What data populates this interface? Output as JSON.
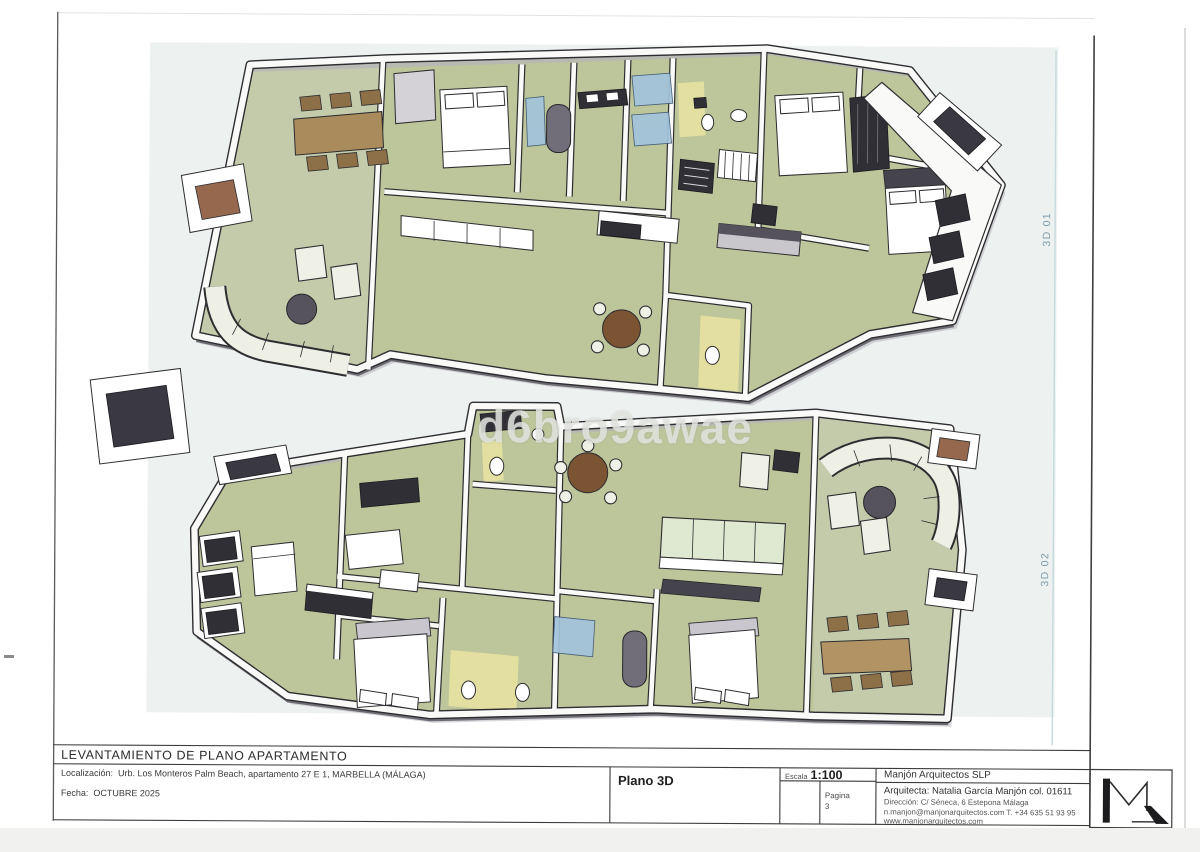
{
  "sheet": {
    "title_row": "LEVANTAMIENTO DE PLANO APARTAMENTO",
    "location": {
      "label": "Localización:",
      "value": "Urb. Los Monteros Palm Beach, apartamento 27 E 1, MARBELLA (MÁLAGA)"
    },
    "date": {
      "label": "Fecha:",
      "value": "OCTUBRE 2025"
    },
    "drawing_name": "Plano 3D",
    "scale": {
      "label": "Escala",
      "value": "1:100"
    },
    "page": {
      "label": "Pagina",
      "value": "3"
    },
    "firm": {
      "name": "Manjón Arquitectos SLP",
      "architect": "Arquitecta: Natalia García Manjón col. 01611",
      "address": "Dirección: C/ Séneca, 6 Estepona Málaga",
      "contact": "n.manjon@manjonarquitectos.com T. +34 635 51 93 95",
      "web": "www.manjonarquitectos.com"
    }
  },
  "views": {
    "v1": "3D 01",
    "v2": "3D 02"
  },
  "watermark": "d6bro9awae",
  "colors": {
    "floor_green": "#bdc59b",
    "wall_white": "#f9f9f7",
    "annotation_blue": "#7d9dab",
    "counter_blue": "#a2c3db",
    "wood_brown": "#aa8c5c",
    "paper_tint": "#edf2f0"
  }
}
